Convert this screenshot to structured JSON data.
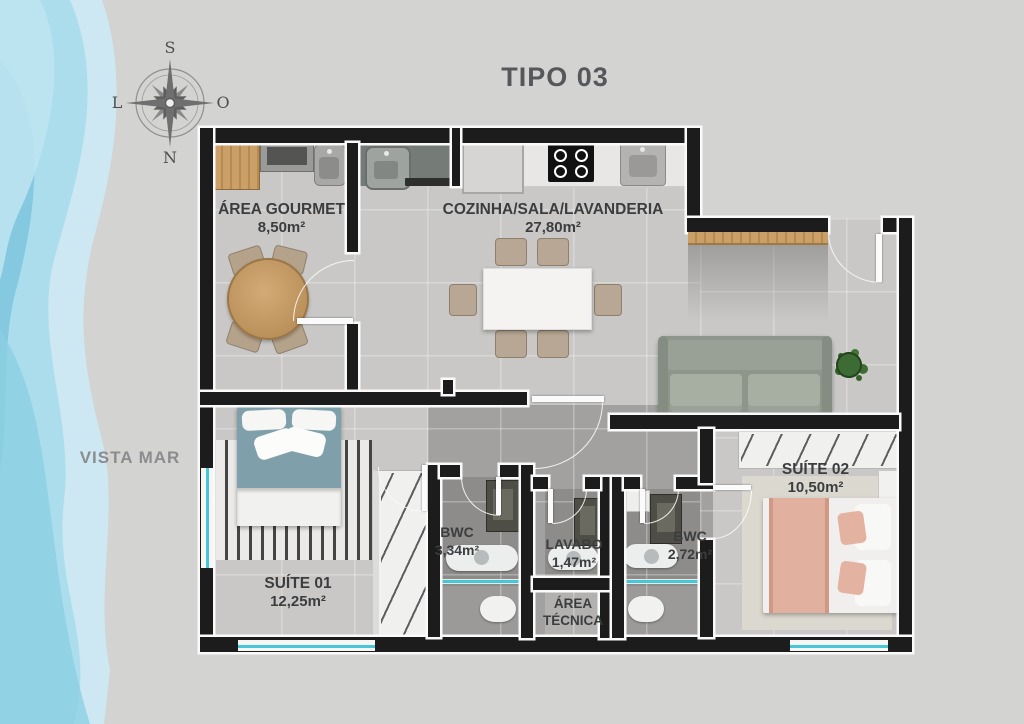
{
  "page": {
    "title": "TIPO 03",
    "side_label": "VISTA MAR"
  },
  "compass": {
    "top": "S",
    "bottom": "N",
    "left": "L",
    "right": "O"
  },
  "rooms": {
    "gourmet": {
      "name": "ÁREA GOURMET",
      "area": "8,50m²"
    },
    "living": {
      "name": "COZINHA/SALA/LAVANDERIA",
      "area": "27,80m²"
    },
    "suite1": {
      "name": "SUÍTE 01",
      "area": "12,25m²"
    },
    "bwc1": {
      "name": "BWC",
      "area": "3,34m²"
    },
    "lavabo": {
      "name": "LAVABO",
      "area": "1,47m²"
    },
    "bwc2": {
      "name": "BWC",
      "area": "2,72m²"
    },
    "tecnica": {
      "name": "ÁREA TÉCNICA"
    },
    "suite2": {
      "name": "SUÍTE 02",
      "area": "10,50m²"
    }
  },
  "colors": {
    "wall": "#1c1c1c",
    "window_glass": "#45c7d6",
    "label_text": "#3c3d3f",
    "title_text": "#56575a",
    "watercolor": [
      "#cde8f2",
      "#a9dcec",
      "#7cc6dd"
    ]
  },
  "furniture": [
    "wood-cabinet",
    "grill-counter",
    "gourmet-sink",
    "round-dining-table",
    "dining-chair",
    "kitchen-sink",
    "fridge",
    "cooktop",
    "laundry-tank",
    "bar-counter",
    "dining-table",
    "sofa",
    "potted-plant",
    "double-bed",
    "striped-rug",
    "wardrobe",
    "bathroom-vanity",
    "counter-sink",
    "toilet",
    "shower-glass",
    "nightstand"
  ]
}
